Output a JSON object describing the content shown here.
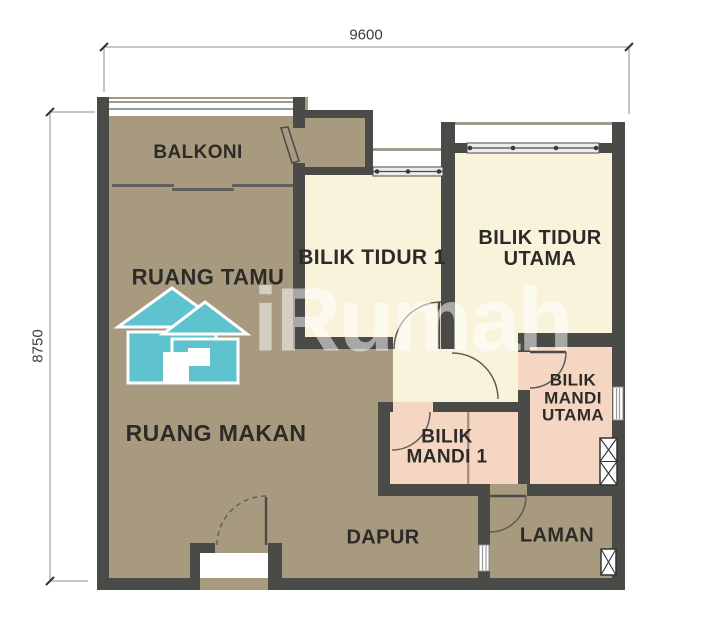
{
  "plan": {
    "rooms": {
      "balkoni": {
        "label": "BALKONI"
      },
      "ruang_tamu": {
        "label": "RUANG TAMU"
      },
      "bilik_tidur_1": {
        "label": "BILIK TIDUR 1"
      },
      "bilik_tidur_utama": {
        "label": "BILIK TIDUR\nUTAMA"
      },
      "ruang_makan": {
        "label": "RUANG MAKAN"
      },
      "bilik_mandi_1": {
        "label": "BILIK\nMANDI 1"
      },
      "bilik_mandi_utama": {
        "label": "BILIK\nMANDI\nUTAMA"
      },
      "dapur": {
        "label": "DAPUR"
      },
      "laman": {
        "label": "LAMAN"
      }
    },
    "dimensions": {
      "width_mm": "9600",
      "height_mm": "8750"
    }
  },
  "watermark": {
    "text": "iRumah",
    "icon": "house-icon"
  },
  "colors": {
    "wall": "#4a4a47",
    "brown": "#a89a7f",
    "cream": "#faf3dc",
    "pink": "#f4d6c2",
    "teal": "#5ec3ce",
    "winline": "#9a9a9a",
    "dim": "#8c8c8c",
    "label": "#2d2b28"
  }
}
